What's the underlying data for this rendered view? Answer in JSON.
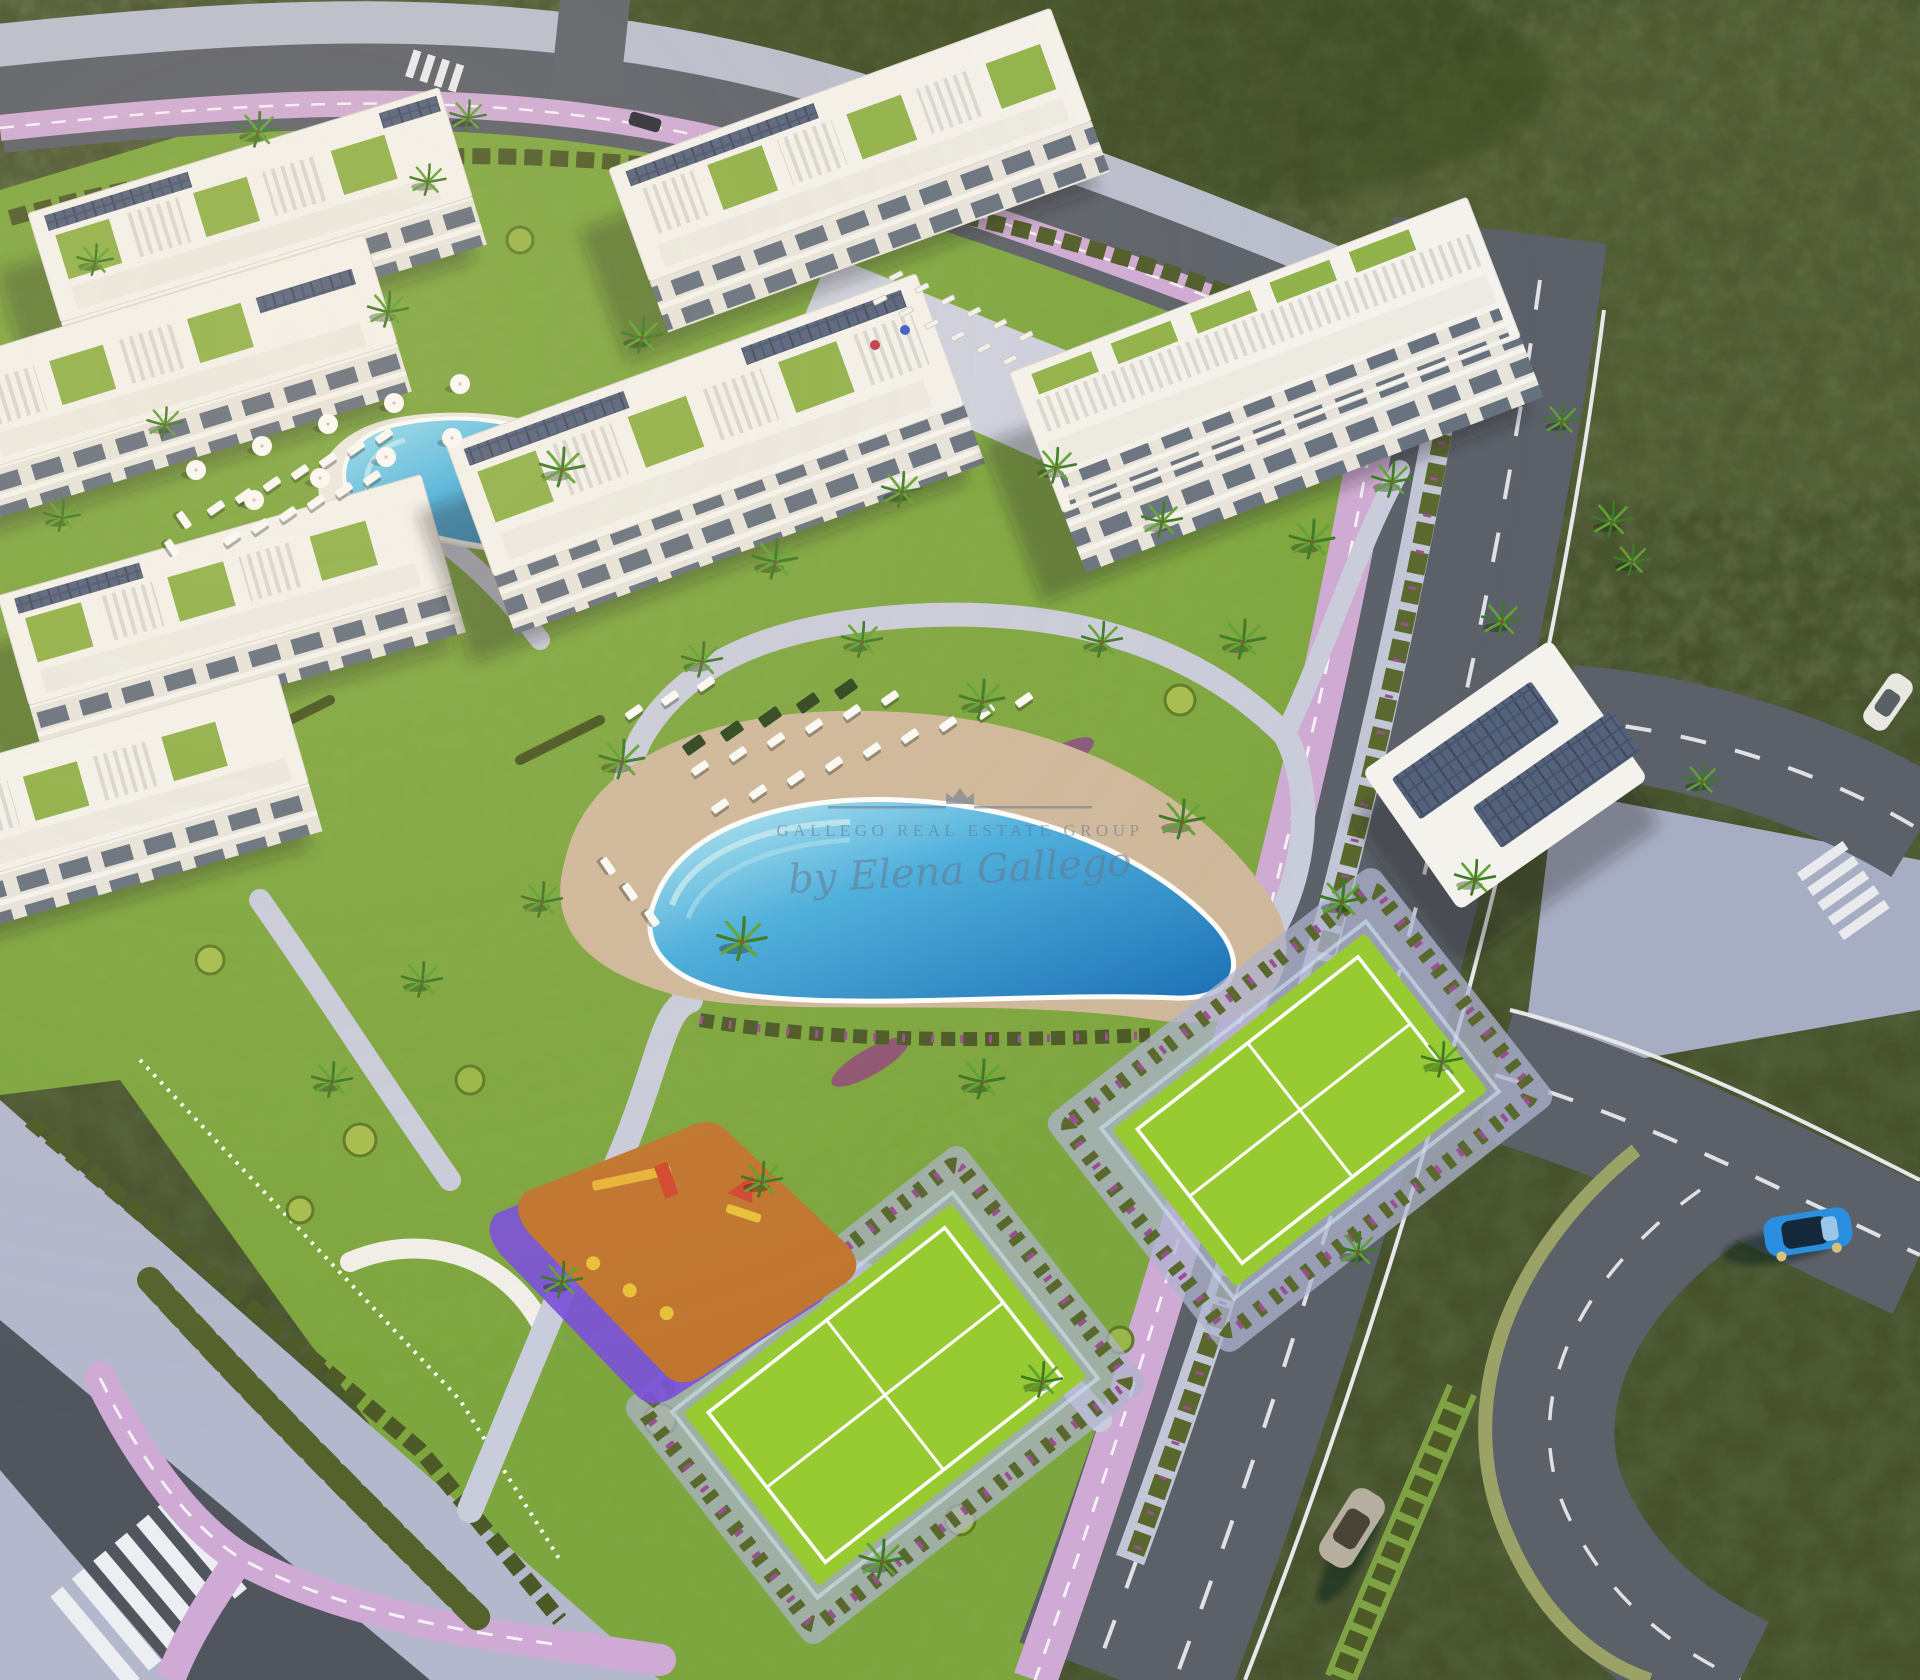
{
  "watermark": {
    "brand_top": "GALLEGO REAL ESTATE GROUP",
    "brand_script": "by Elena Gallego",
    "color": "#64788e"
  },
  "colors": {
    "scrub": "#46512c",
    "scrub_dark": "#2f3a1e",
    "lawn": "#7da63e",
    "lawn_bright": "#95bb4a",
    "court_green": "#98cb32",
    "pool_light": "#8fdcef",
    "pool_deep": "#1f86c8",
    "sand": "#cfb89b",
    "path_gray": "#c9ccdb",
    "asphalt": "#5b6069",
    "bike_lane_pink": "#cfaad4",
    "sidewalk": "#b3b8cc",
    "building_white": "#f4f2ec",
    "facade": "#e7e4dc",
    "glass": "#66717e",
    "solar_panel": "#47536b",
    "hedge": "#55622c",
    "flowers": "#9a4f92",
    "playground_orange": "#c1762f",
    "playground_purple": "#7b51d8",
    "car_blue": "#2b8fe0",
    "car_silver": "#b6ae9f",
    "car_white": "#e9e7e1"
  },
  "scene": {
    "palms": [
      [
        258,
        132,
        0.9
      ],
      [
        468,
        118,
        0.8
      ],
      [
        388,
        312,
        0.9
      ],
      [
        165,
        425,
        0.8
      ],
      [
        62,
        518,
        0.8
      ],
      [
        562,
        470,
        1
      ],
      [
        642,
        338,
        0.9
      ],
      [
        775,
        562,
        1
      ],
      [
        902,
        492,
        0.9
      ],
      [
        1056,
        468,
        0.9
      ],
      [
        1162,
        522,
        0.9
      ],
      [
        1312,
        542,
        1
      ],
      [
        1392,
        482,
        0.9
      ],
      [
        1243,
        642,
        1
      ],
      [
        1102,
        642,
        0.9
      ],
      [
        982,
        702,
        1
      ],
      [
        862,
        642,
        0.9
      ],
      [
        702,
        662,
        0.9
      ],
      [
        622,
        762,
        1
      ],
      [
        542,
        902,
        0.9
      ],
      [
        422,
        982,
        0.9
      ],
      [
        332,
        1082,
        0.9
      ],
      [
        742,
        942,
        1.1
      ],
      [
        1182,
        822,
        1
      ],
      [
        1342,
        902,
        1
      ],
      [
        1442,
        1062,
        0.9
      ],
      [
        1502,
        622,
        0.9
      ],
      [
        1562,
        422,
        0.8
      ],
      [
        1612,
        522,
        0.9
      ],
      [
        982,
        1082,
        1
      ],
      [
        762,
        1182,
        0.9
      ],
      [
        562,
        1282,
        0.9
      ],
      [
        882,
        1562,
        1
      ],
      [
        1042,
        1382,
        0.9
      ],
      [
        1632,
        562,
        0.8
      ],
      [
        1702,
        782,
        0.8
      ],
      [
        95,
        262,
        0.8
      ],
      [
        428,
        182,
        0.8
      ],
      [
        1358,
        1252,
        0.9
      ],
      [
        1475,
        880,
        0.9
      ]
    ],
    "loungers": [
      [
        700,
        768
      ],
      [
        738,
        754
      ],
      [
        776,
        740
      ],
      [
        814,
        726
      ],
      [
        852,
        712
      ],
      [
        890,
        698
      ],
      [
        720,
        806
      ],
      [
        758,
        792
      ],
      [
        796,
        778
      ],
      [
        834,
        764
      ],
      [
        872,
        750
      ],
      [
        910,
        736
      ],
      [
        634,
        712
      ],
      [
        670,
        698
      ],
      [
        706,
        684
      ],
      [
        608,
        866,
        55
      ],
      [
        630,
        892,
        55
      ],
      [
        652,
        918,
        55
      ],
      [
        948,
        724
      ],
      [
        986,
        712
      ],
      [
        1024,
        700
      ],
      [
        216,
        508
      ],
      [
        244,
        496
      ],
      [
        272,
        484
      ],
      [
        300,
        472
      ],
      [
        328,
        460
      ],
      [
        356,
        448
      ],
      [
        384,
        436
      ],
      [
        232,
        538
      ],
      [
        260,
        526
      ],
      [
        288,
        514
      ],
      [
        316,
        502
      ],
      [
        344,
        490
      ],
      [
        372,
        478
      ],
      [
        184,
        520,
        55
      ],
      [
        172,
        548,
        55
      ]
    ],
    "umbrellas": [
      [
        196,
        470
      ],
      [
        262,
        446
      ],
      [
        328,
        424
      ],
      [
        394,
        403
      ],
      [
        460,
        384
      ],
      [
        254,
        500
      ],
      [
        320,
        478
      ],
      [
        386,
        457
      ],
      [
        452,
        438
      ]
    ],
    "bike_racks": [
      [
        880,
        300
      ],
      [
        906,
        312
      ],
      [
        932,
        324
      ],
      [
        958,
        336
      ],
      [
        984,
        348
      ],
      [
        1010,
        360
      ],
      [
        896,
        276
      ],
      [
        922,
        288
      ],
      [
        948,
        300
      ],
      [
        974,
        312
      ],
      [
        1000,
        324
      ],
      [
        1026,
        336
      ]
    ],
    "shade_mats": [
      [
        694,
        745
      ],
      [
        732,
        731
      ],
      [
        770,
        717
      ],
      [
        808,
        703
      ],
      [
        846,
        689
      ]
    ]
  }
}
